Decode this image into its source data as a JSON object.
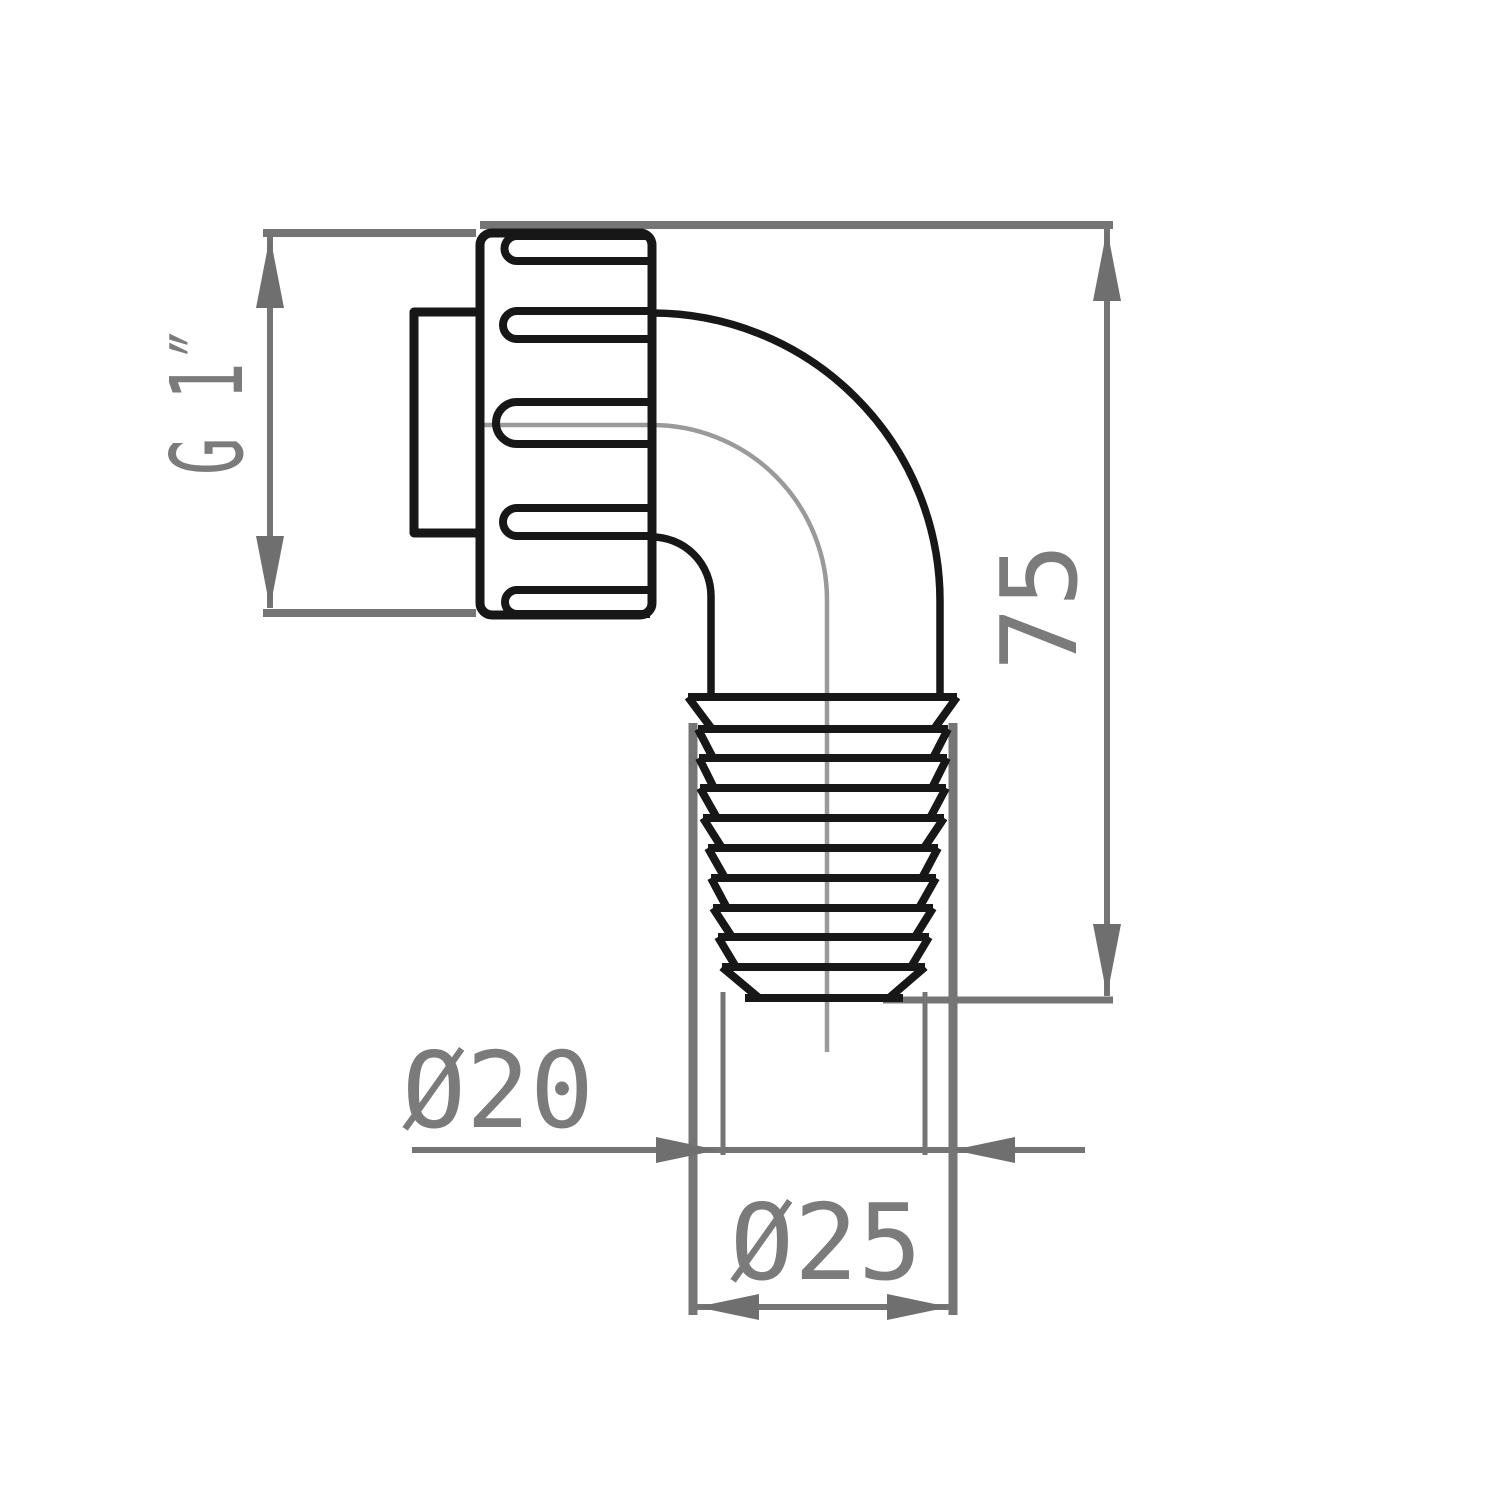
{
  "title": "pipe-elbow-fitting-technical-drawing",
  "drawing": {
    "canvas": {
      "w": 1500,
      "h": 1500,
      "bg": "#ffffff"
    },
    "colors": {
      "outline": "#171717",
      "dimension": "#757575",
      "arrow": "#6f6f6f",
      "centerline": "#9a9a9a",
      "text": "#7b7b7b"
    },
    "nut": {
      "x": 480,
      "y": 233,
      "w": 172,
      "h": 382,
      "rx": 12,
      "stroke": 9
    },
    "stub": {
      "x": 414,
      "y": 312,
      "w": 66,
      "h": 221,
      "stroke": 9
    },
    "slots": {
      "capX": 517,
      "rightX": 650,
      "stroke": 8,
      "items": [
        {
          "top": 236,
          "bottom": 261
        },
        {
          "top": 311,
          "bottom": 339
        },
        {
          "top": 402,
          "bottom": 444
        },
        {
          "top": 508,
          "bottom": 536
        },
        {
          "top": 590,
          "bottom": 614
        }
      ]
    },
    "elbow": {
      "stroke": 7.5,
      "outer": {
        "sx": 652,
        "sy": 313,
        "ex": 940,
        "ey": 601,
        "r": 288,
        "dropY": 699
      },
      "inner": {
        "sx": 652,
        "sy": 537,
        "ex": 711,
        "ey": 596,
        "r": 59,
        "dropY": 699
      }
    },
    "centerline": {
      "stroke": 4.5,
      "hx1": 483,
      "hy": 425,
      "elbowX": 652,
      "r": 175,
      "vx": 827,
      "vy2": 1052
    },
    "barb": {
      "stroke": 8,
      "inset": 14,
      "ridges": [
        {
          "y": 697,
          "x1": 688,
          "x2": 957
        },
        {
          "y": 729,
          "x1": 698,
          "x2": 948
        },
        {
          "y": 758,
          "x1": 699,
          "x2": 947
        },
        {
          "y": 788,
          "x1": 700,
          "x2": 946
        },
        {
          "y": 818,
          "x1": 703,
          "x2": 944
        },
        {
          "y": 848,
          "x1": 708,
          "x2": 938
        },
        {
          "y": 878,
          "x1": 711,
          "x2": 936
        },
        {
          "y": 908,
          "x1": 713,
          "x2": 933
        },
        {
          "y": 937,
          "x1": 718,
          "x2": 929
        },
        {
          "y": 967,
          "x1": 722,
          "x2": 925
        }
      ],
      "bottom": {
        "y": 998,
        "x1": 745,
        "x2": 903
      }
    },
    "gray_lines": [
      {
        "name": "g1-ext-top",
        "x1": 263,
        "y1": 233,
        "x2": 476,
        "y2": 233,
        "w": 8
      },
      {
        "name": "g1-ext-bottom",
        "x1": 263,
        "y1": 613,
        "x2": 476,
        "y2": 613,
        "w": 8
      },
      {
        "name": "h75-ext-top",
        "x1": 480,
        "y1": 225,
        "x2": 1113,
        "y2": 225,
        "w": 8
      },
      {
        "name": "h75-ext-bottom",
        "x1": 883,
        "y1": 1000,
        "x2": 1113,
        "y2": 1000,
        "w": 7
      },
      {
        "name": "d25-ext-left",
        "x1": 693,
        "y1": 723,
        "x2": 693,
        "y2": 1315,
        "w": 9
      },
      {
        "name": "d25-ext-right",
        "x1": 953,
        "y1": 723,
        "x2": 953,
        "y2": 1315,
        "w": 9
      },
      {
        "name": "d20-ext-left",
        "x1": 723,
        "y1": 992,
        "x2": 723,
        "y2": 1155,
        "w": 5
      },
      {
        "name": "d20-ext-right",
        "x1": 925,
        "y1": 992,
        "x2": 925,
        "y2": 1155,
        "w": 5
      },
      {
        "name": "g1-dim-line",
        "x1": 270,
        "y1": 236,
        "x2": 270,
        "y2": 608,
        "w": 6
      },
      {
        "name": "h75-dim-line",
        "x1": 1107,
        "y1": 229,
        "x2": 1107,
        "y2": 996,
        "w": 6
      },
      {
        "name": "d20-dim-line",
        "x1": 412,
        "y1": 1150,
        "x2": 1085,
        "y2": 1150,
        "w": 6
      },
      {
        "name": "d25-dim-line",
        "x1": 697,
        "y1": 1307,
        "x2": 949,
        "y2": 1307,
        "w": 6
      }
    ],
    "arrows": [
      {
        "name": "g1-arrow-up",
        "x": 270,
        "y": 236,
        "dir": "up",
        "len": 72,
        "hw": 14
      },
      {
        "name": "g1-arrow-down",
        "x": 270,
        "y": 608,
        "dir": "down",
        "len": 72,
        "hw": 14
      },
      {
        "name": "h75-arrow-up",
        "x": 1107,
        "y": 229,
        "dir": "up",
        "len": 72,
        "hw": 14
      },
      {
        "name": "h75-arrow-down",
        "x": 1107,
        "y": 996,
        "dir": "down",
        "len": 72,
        "hw": 14
      },
      {
        "name": "d20-arrow-left",
        "x": 718,
        "y": 1150,
        "dir": "right",
        "len": 62,
        "hw": 13
      },
      {
        "name": "d20-arrow-right",
        "x": 953,
        "y": 1150,
        "dir": "left",
        "len": 62,
        "hw": 13
      },
      {
        "name": "d25-arrow-left",
        "x": 697,
        "y": 1307,
        "dir": "left",
        "len": 62,
        "hw": 13
      },
      {
        "name": "d25-arrow-right",
        "x": 949,
        "y": 1307,
        "dir": "right",
        "len": 62,
        "hw": 13
      }
    ]
  },
  "dimensions": {
    "g1": {
      "label": "G 1″",
      "meaning": "thread size",
      "text": {
        "cx": 206,
        "cy": 400,
        "fs": 100,
        "len": 150,
        "rotate": true
      }
    },
    "h75": {
      "label": "75",
      "meaning": "overall height mm",
      "text": {
        "cx": 1038,
        "cy": 607,
        "fs": 105,
        "len": 128,
        "rotate": true
      }
    },
    "d20": {
      "label": "Ø20",
      "meaning": "inner diameter mm",
      "text": {
        "cx": 498,
        "cy": 1089,
        "fs": 105,
        "len": 192,
        "rotate": false
      }
    },
    "d25": {
      "label": "Ø25",
      "meaning": "outer diameter mm",
      "text": {
        "cx": 826,
        "cy": 1241,
        "fs": 105,
        "len": 192,
        "rotate": false
      }
    }
  }
}
